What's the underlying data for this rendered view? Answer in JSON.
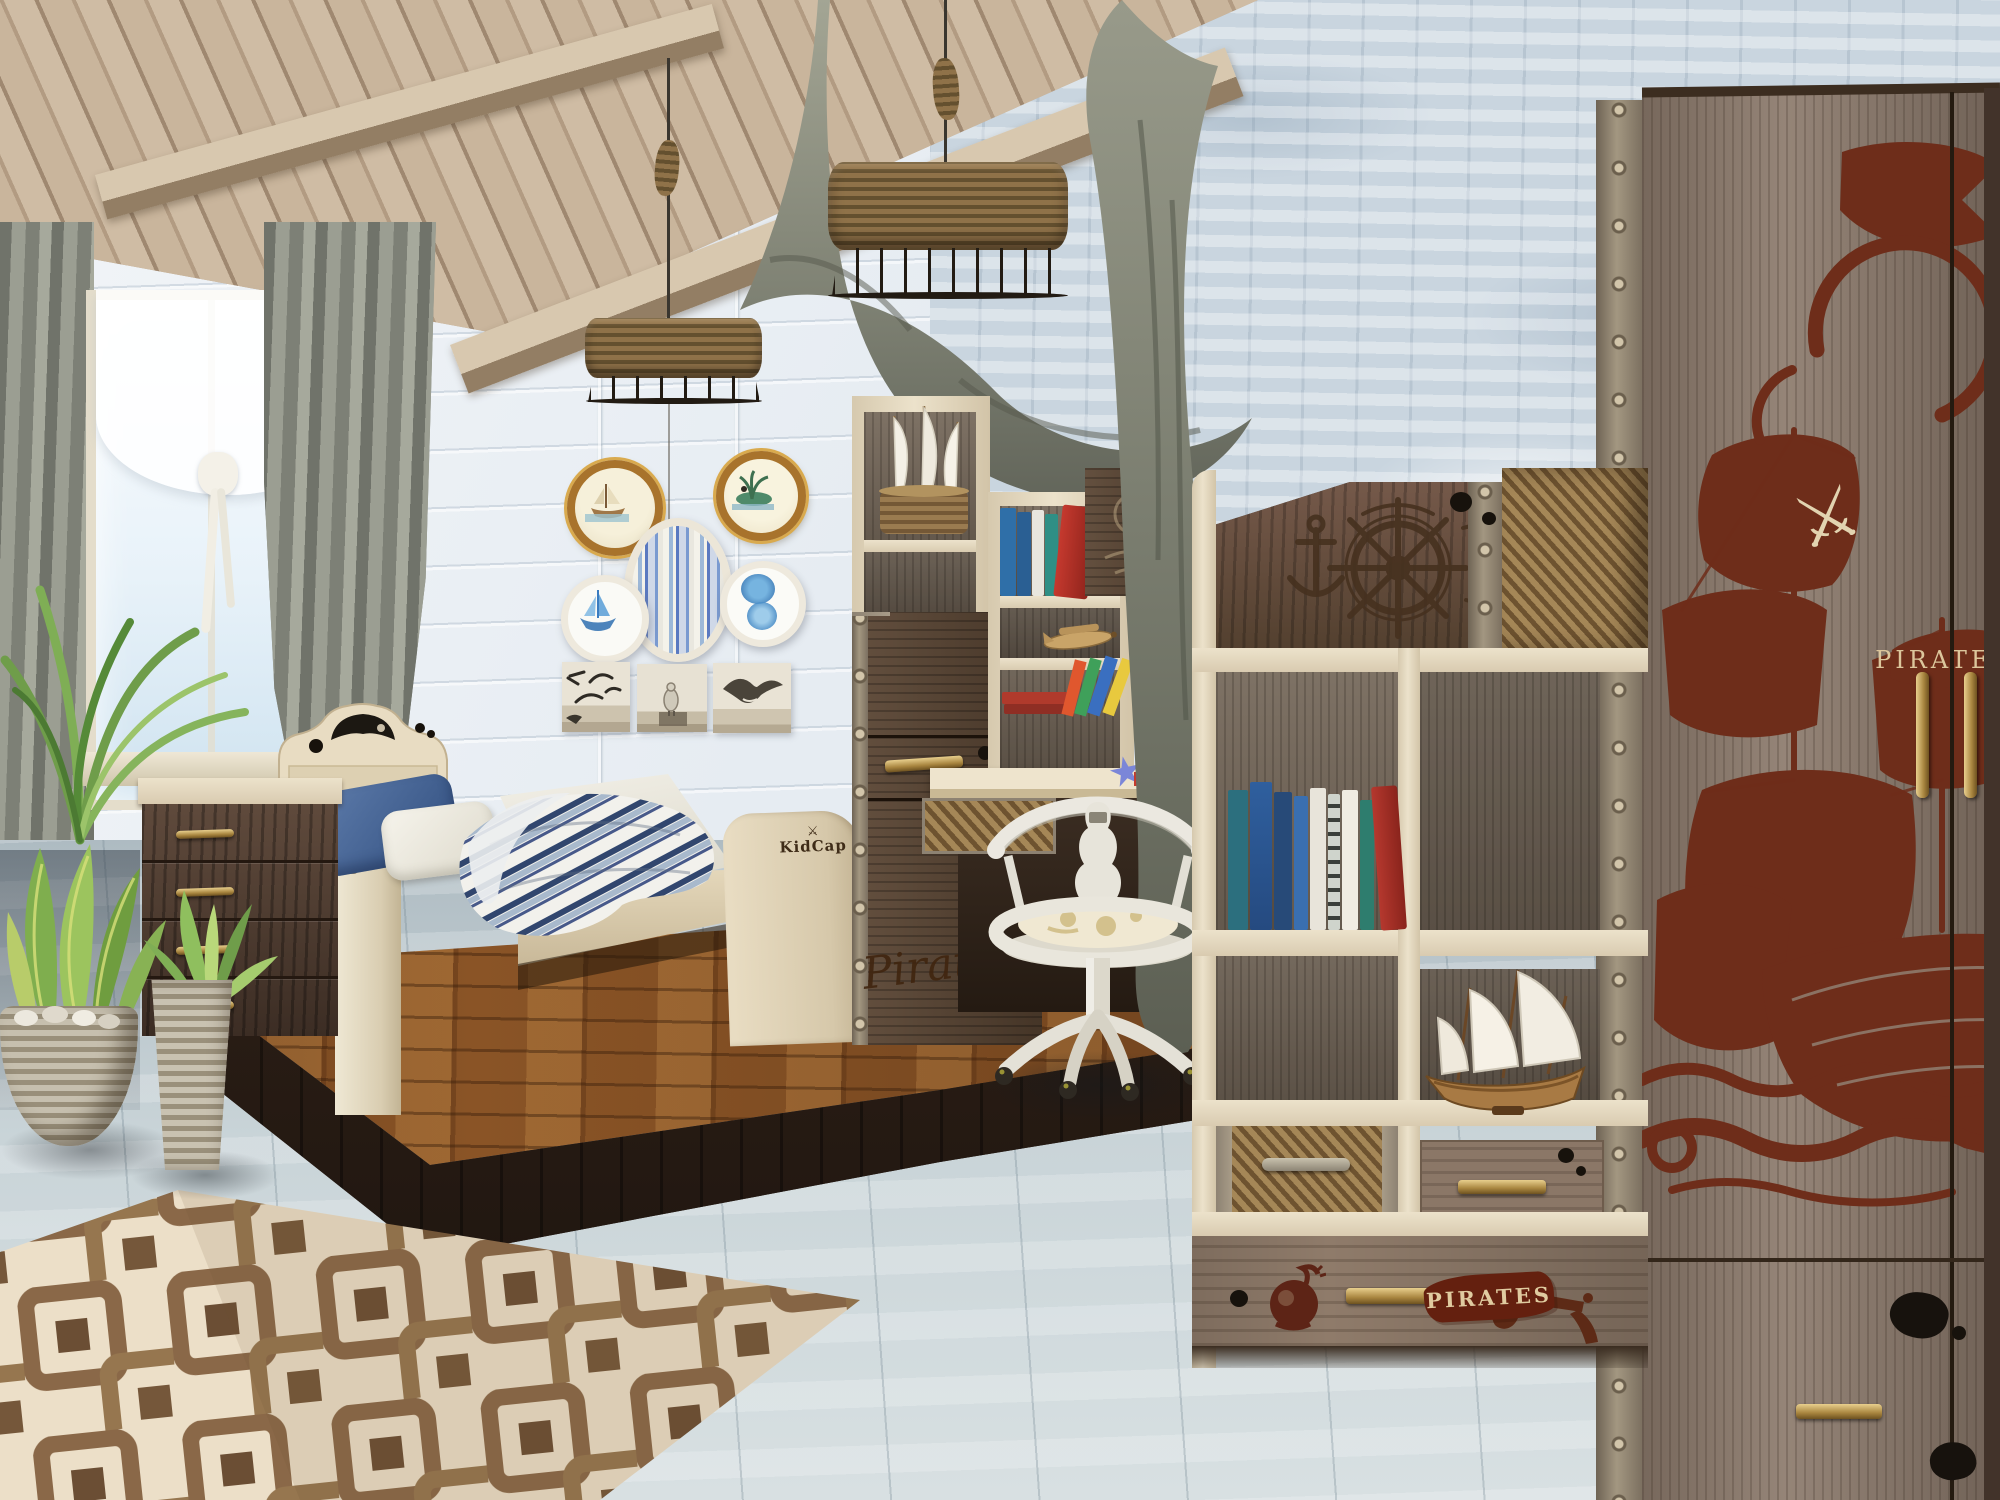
{
  "scene": {
    "type": "3D interior render",
    "theme": "pirate-themed children's bedroom",
    "objects": [
      "bed",
      "chest-of-drawers",
      "desk-with-hutch",
      "swivel-chair",
      "bookcase",
      "wardrobe",
      "pendant-lights",
      "wall-frames",
      "rug",
      "plants"
    ]
  },
  "texts": {
    "wardrobe_banner": "PIRATES",
    "bookcase_drawer_label": "PIRATES",
    "cabinet_script": "Pirates",
    "bed_logo": "KidCap",
    "crossed_swords_icon": "⚔"
  },
  "palette": {
    "wall": "#e9eef3",
    "wall_right": "#c9d5df",
    "ceiling_wood": "#bca68c",
    "curtain": "#878a7f",
    "cream_wood": "#e6dbc2",
    "walnut": "#4f3d33",
    "warm_floor": "#8a5426",
    "cool_floor": "#c3ced3",
    "rug_cream": "#ecdfc8",
    "rug_brown": "#8a6848",
    "graphic_red": "#6e2d1a",
    "brass": "#c8a45c",
    "denim": "#4a689c",
    "rope": "#8a6c44"
  }
}
